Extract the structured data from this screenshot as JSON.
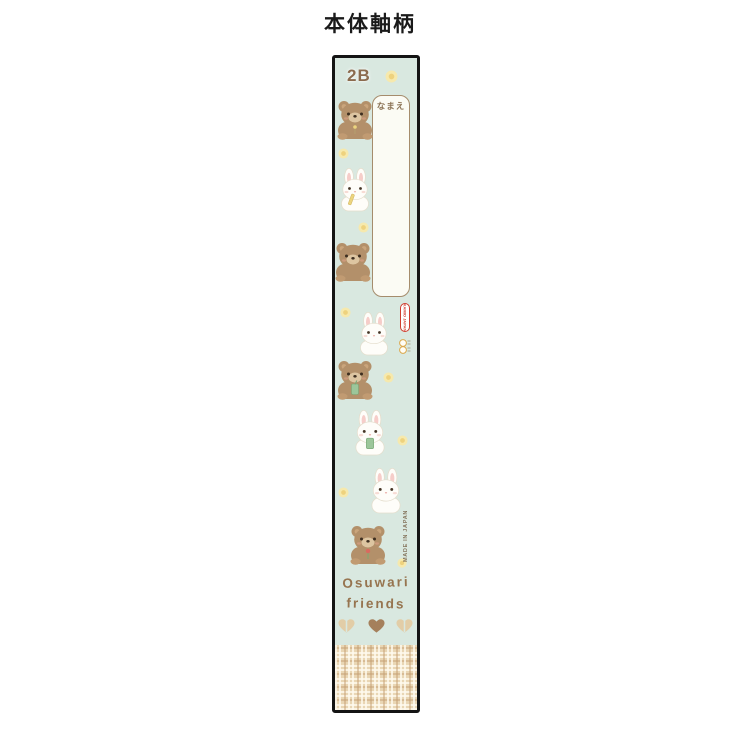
{
  "page": {
    "title": "本体軸柄"
  },
  "pencil": {
    "grade": "2B",
    "name_field_label": "なまえ",
    "brand_logo": "KAMIO JAPAN",
    "made_in": "MADE IN JAPAN",
    "series_line1": "Osuwari",
    "series_line2": "friends",
    "colors": {
      "body_mint": "#d9e8e0",
      "plaid_base": "#e9d6b4",
      "grade_brown": "#8b6b4e",
      "series_brown": "#96744f",
      "logo_red": "#d03c2e",
      "flower_yellow": "#f6e9ad",
      "bear_fur": "#b3906a",
      "rabbit_white": "#fefdf9",
      "heart_brown": "#a5805c",
      "bow_tan": "#e2cda7"
    },
    "motifs": [
      {
        "name": "bear-motif",
        "kind": "bear",
        "accessory": "sprig",
        "left": 0,
        "top": 40,
        "w": 40,
        "h": 42
      },
      {
        "name": "rabbit-motif",
        "kind": "rabbit",
        "accessory": "pencil",
        "left": 3,
        "top": 110,
        "w": 34,
        "h": 44
      },
      {
        "name": "bear-motif",
        "kind": "bear",
        "left": -2,
        "top": 182,
        "w": 40,
        "h": 42
      },
      {
        "name": "rabbit-motif",
        "kind": "rabbit",
        "left": 22,
        "top": 254,
        "w": 34,
        "h": 44
      },
      {
        "name": "bear-motif",
        "kind": "bear",
        "accessory": "drink",
        "left": 0,
        "top": 300,
        "w": 40,
        "h": 42
      },
      {
        "name": "rabbit-motif",
        "kind": "rabbit",
        "accessory": "drink",
        "left": 17,
        "top": 352,
        "w": 36,
        "h": 46
      },
      {
        "name": "rabbit-motif",
        "kind": "rabbit",
        "left": 33,
        "top": 410,
        "w": 36,
        "h": 46
      },
      {
        "name": "bear-motif",
        "kind": "bear",
        "accessory": "flower",
        "left": 13,
        "top": 465,
        "w": 40,
        "h": 42
      },
      {
        "name": "flower-motif",
        "kind": "flower",
        "left": 50,
        "top": 12,
        "w": 13,
        "h": 13
      },
      {
        "name": "flower-motif",
        "kind": "flower",
        "left": 3,
        "top": 90,
        "w": 11,
        "h": 11
      },
      {
        "name": "flower-motif",
        "kind": "flower",
        "left": 23,
        "top": 164,
        "w": 11,
        "h": 11
      },
      {
        "name": "flower-motif",
        "kind": "flower",
        "left": 5,
        "top": 249,
        "w": 11,
        "h": 11
      },
      {
        "name": "flower-motif",
        "kind": "flower",
        "left": 48,
        "top": 314,
        "w": 11,
        "h": 11
      },
      {
        "name": "flower-motif",
        "kind": "flower",
        "left": 62,
        "top": 377,
        "w": 11,
        "h": 11
      },
      {
        "name": "flower-motif",
        "kind": "flower",
        "left": 3,
        "top": 429,
        "w": 11,
        "h": 11
      },
      {
        "name": "flower-motif",
        "kind": "flower",
        "left": 62,
        "top": 500,
        "w": 10,
        "h": 10
      },
      {
        "name": "bow-motif",
        "kind": "bow",
        "left": 3,
        "top": 560,
        "w": 17,
        "h": 16
      },
      {
        "name": "heart-motif",
        "kind": "heart",
        "left": 33,
        "top": 560,
        "w": 17,
        "h": 16
      },
      {
        "name": "bow-motif",
        "kind": "bow",
        "left": 61,
        "top": 560,
        "w": 17,
        "h": 16
      }
    ]
  }
}
